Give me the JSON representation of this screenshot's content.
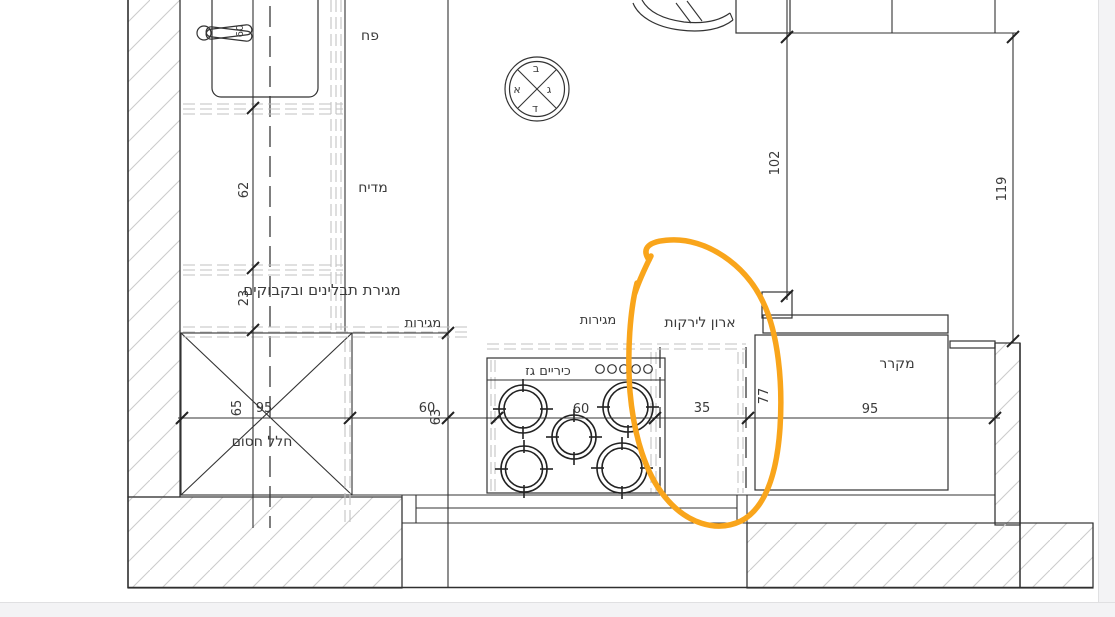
{
  "drawing": {
    "type": "kitchen-floor-plan",
    "line_color": "#333333",
    "hatch_color": "#cccccc"
  },
  "labels": {
    "trash": "פח",
    "dishwasher": "מדיח",
    "spice_bottles_drawer": "מגירת תבלינים ובקבוקים",
    "drawers_left": "מגירות",
    "drawers_center": "מגירות",
    "gas_cooktop": "כיריים גז",
    "vegetable_cabinet": "ארון לירקות",
    "refrigerator": "מקרר",
    "blocked_space": "חלל חסום"
  },
  "compass": {
    "top": "ב",
    "left": "א",
    "right": "ג",
    "bottom": "ד"
  },
  "dimensions": {
    "sink_width": "60",
    "left_run_depth": "62",
    "spice_drawer_depth": "23",
    "blocked_width": "65",
    "blocked_length": "95",
    "island_seg_a": "60",
    "island_seg_b": "63",
    "cooktop_width": "60",
    "vegetable_cabinet_width": "35",
    "vegetable_cabinet_depth": "77",
    "fridge_width": "95",
    "top_clearance_left": "102",
    "top_clearance_right": "119"
  },
  "annotation": {
    "name": "hand-drawn orange highlight around vegetable cabinet",
    "color": "#F9A51B"
  }
}
